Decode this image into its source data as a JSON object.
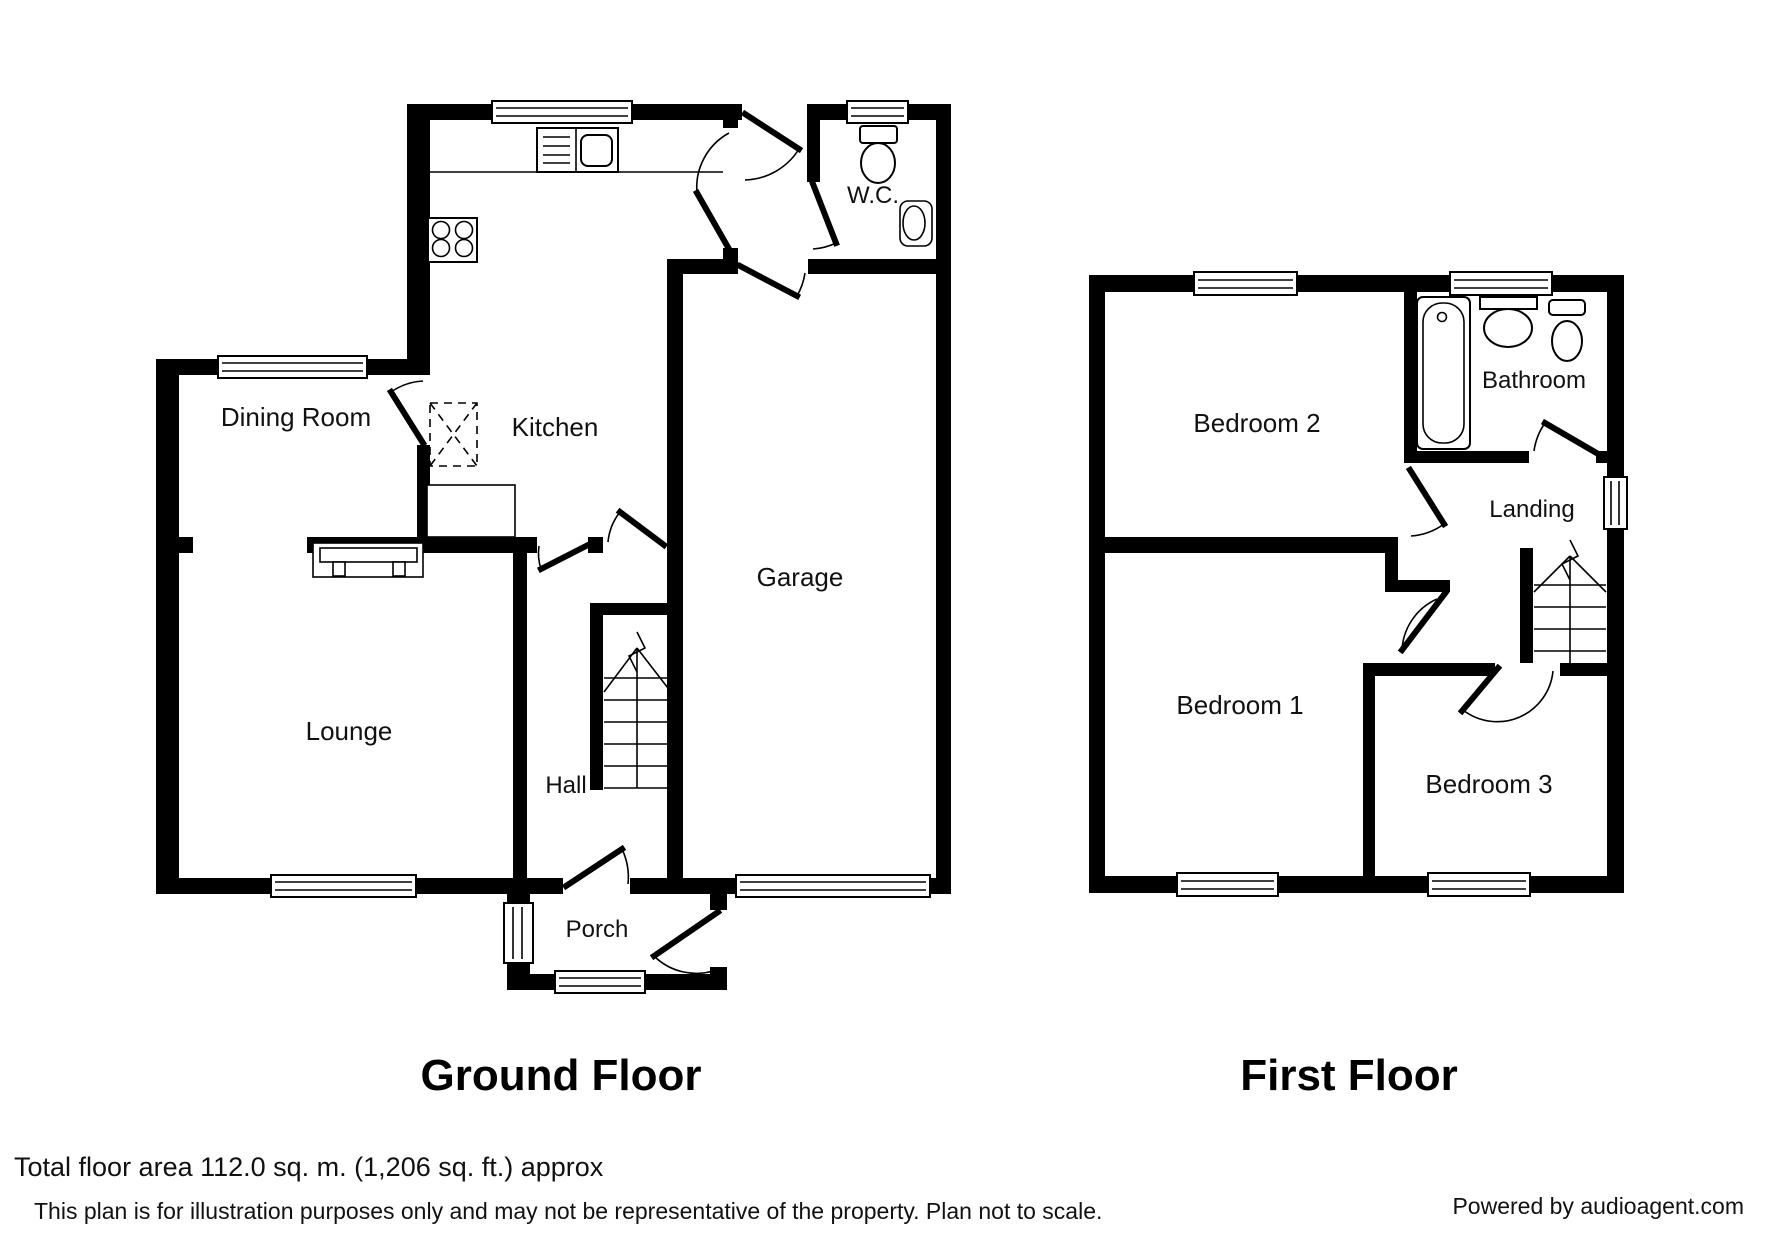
{
  "plan": {
    "ground_floor": {
      "title": "Ground Floor",
      "rooms": {
        "kitchen": "Kitchen",
        "dining_room": "Dining Room",
        "lounge": "Lounge",
        "hall": "Hall",
        "porch": "Porch",
        "garage": "Garage",
        "wc": "W.C."
      }
    },
    "first_floor": {
      "title": "First Floor",
      "rooms": {
        "bedroom1": "Bedroom 1",
        "bedroom2": "Bedroom 2",
        "bedroom3": "Bedroom 3",
        "bathroom": "Bathroom",
        "landing": "Landing"
      }
    }
  },
  "footer": {
    "area_text": "Total floor area 112.0 sq. m. (1,206 sq. ft.) approx",
    "disclaimer": "This plan is for illustration purposes only and may not be representative of the property. Plan not to scale.",
    "credit": "Powered by audioagent.com"
  },
  "colors": {
    "wall": "#000000",
    "background": "#ffffff"
  }
}
